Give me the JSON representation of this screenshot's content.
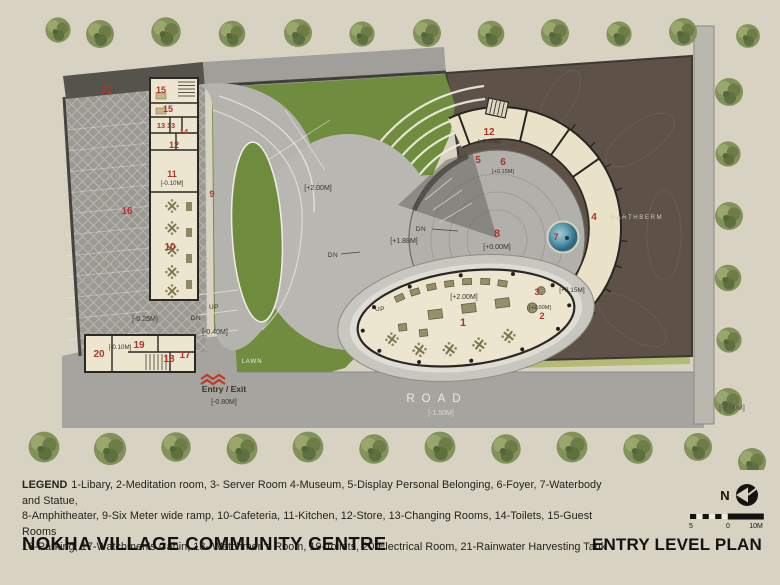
{
  "colors": {
    "page_bg": "#d8d2c2",
    "accent_red": "#ae352a",
    "lawn_green": "#708c3e",
    "concrete_gray": "#b8b7b1",
    "cream_building": "#ece5cf",
    "earthberm_brown": "#5e5147",
    "road_gray": "#a5a49f",
    "parking_gray": "#9b9992",
    "water_blue": "#4d8ba0",
    "wall_dark": "#2b2822"
  },
  "plan": {
    "labels": {
      "n1": "1",
      "n2": "2",
      "n3": "3",
      "n4": "4",
      "n5": "5",
      "n6": "6",
      "n7": "7",
      "n8": "8",
      "n9": "9",
      "n10": "10",
      "n11": "11",
      "n12_ring": "12",
      "n12_strip": "12",
      "n13a": "13",
      "n13b": "13",
      "n14": "14",
      "n15a": "15",
      "n15b": "15",
      "n16": "16",
      "n17": "17",
      "n18": "18",
      "n19": "19",
      "n20": "20",
      "n21": "21",
      "lvl_m010_kitchen": "[-0.10M]",
      "lvl_m010_entry": "[-0.10M]",
      "lvl_m025": "[-0.25M]",
      "lvl_m040": "[-0.40M]",
      "lvl_m080": "[-0.80M]",
      "lvl_m150": "[-1.50M]",
      "lvl_m200": "[-2.00M]",
      "lvl_p000": "[+0.00M]",
      "lvl_p015_store": "[+0.15M]",
      "lvl_p015_foyer": "[+0.15M]",
      "lvl_p015_ring": "[+0.15M]",
      "lvl_p188": "[+1.88M]",
      "lvl_p200_ramp": "[+2.00M]",
      "lvl_p200_library": "[+2.00M]",
      "lvl_p200_room2": "[+2.00M]",
      "up_ramp": "UP",
      "dn_ramp": "DN",
      "up_oval": "UP",
      "dn_body": "DN",
      "dn_steps": "DN",
      "lawn": "LAWN",
      "road": "ROAD",
      "earthberm": "EARTHBERM",
      "entry_exit": "Entry / Exit"
    }
  },
  "legend": {
    "title": "LEGEND",
    "lines": [
      "1-Libary, 2-Meditation room, 3- Server Room 4-Museum, 5-Display Personal Belonging, 6-Foyer, 7-Waterbody and Statue,",
      "8-Amphitheater, 9-Six Meter wide ramp, 10-Cafeteria, 11-Kitchen, 12-Store, 13-Changing Rooms, 14-Toilets, 15-Guest Rooms",
      "16-Parking, 17-Watchmen's Cabin, 18- Watchmen's Room, 19-Toilets, 20-Electrical Room, 21-Rainwater Harvesting Tank"
    ]
  },
  "footer": {
    "project_title": "NOKHA VILLAGE COMMUNITY CENTRE",
    "plan_title": "ENTRY LEVEL PLAN"
  },
  "compass": {
    "north_label": "N"
  },
  "scalebar": {
    "left": "5",
    "mid": "0",
    "right": "10M"
  }
}
